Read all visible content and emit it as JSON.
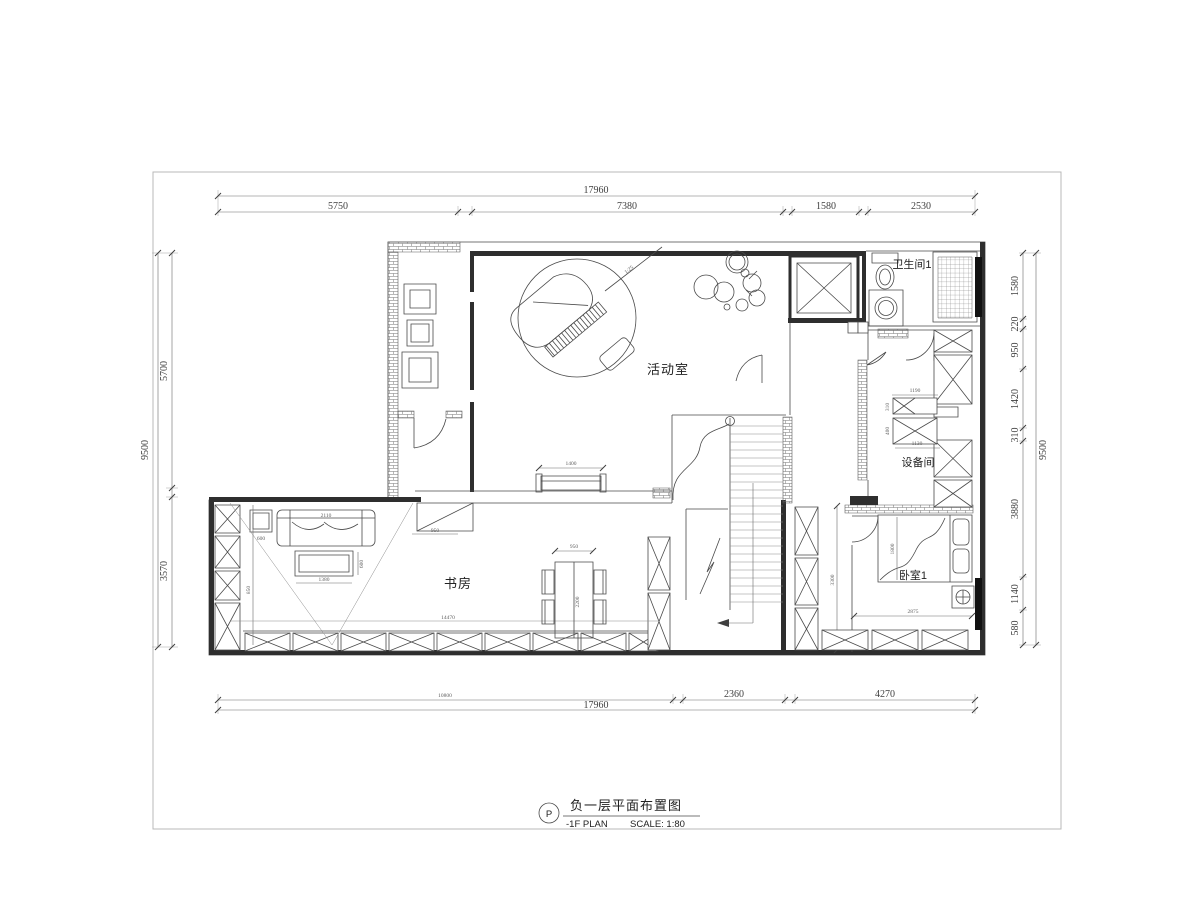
{
  "title_block": {
    "tag": "P",
    "title_cn": "负一层平面布置图",
    "title_en": "-1F PLAN",
    "scale": "SCALE: 1:80"
  },
  "rooms": {
    "activity": "活动室",
    "study": "书房",
    "bathroom": "卫生间1",
    "equipment": "设备间",
    "bedroom": "卧室1"
  },
  "detail": {
    "piano_scale": "1:25"
  },
  "dims": {
    "top_total": "17960",
    "top_1": "5750",
    "top_2": "7380",
    "top_3": "1580",
    "top_4": "2530",
    "left_total": "9500",
    "left_1": "5700",
    "left_2": "3570",
    "right_total": "9500",
    "right_1": "1580",
    "right_2": "220",
    "right_3": "950",
    "right_4": "1420",
    "right_5": "310",
    "right_6": "3880",
    "right_7": "1140",
    "right_8": "580",
    "bottom_total": "17960",
    "bottom_1": "10800",
    "bottom_2": "2360",
    "bottom_3": "4270",
    "bench": "1400",
    "floor_len": "14470",
    "seat": "950",
    "sofa": "2110",
    "side_table": "600",
    "coffee_w": "1380",
    "coffee_d": "600",
    "study_depth": "850",
    "table_w": "950",
    "table_l": "2200",
    "bed": "1800",
    "corridor_h": "3300",
    "bedroom_w": "2875",
    "equip_1": "1190",
    "equip_2": "310",
    "equip_3": "400",
    "equip_4": "1130"
  },
  "colors": {
    "line": "#4a4a4a",
    "wall": "#2e2e2e",
    "window": "#111111"
  }
}
